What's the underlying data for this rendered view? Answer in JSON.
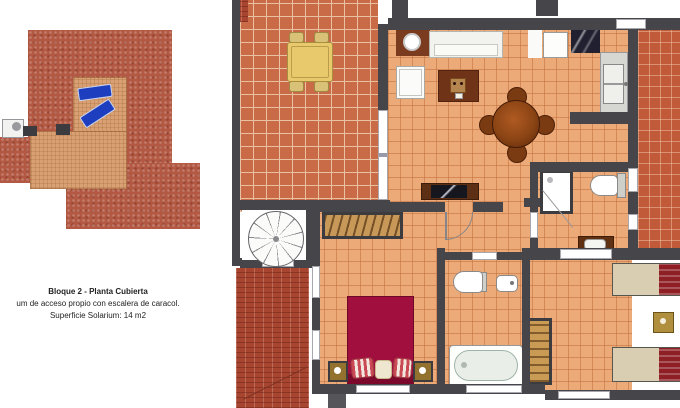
{
  "document": {
    "type": "architectural floor plan sheet",
    "background": "#ffffff"
  },
  "caption": {
    "title": "Bloque 2 - Planta Cubierta",
    "subtitle": "um de acceso propio con escalera de caracol.",
    "area": "Superficie Solarium: 14 m2"
  },
  "left_plan": {
    "name": "roof-solarium-plan",
    "elements": [
      "tiled-roof",
      "solarium-deck",
      "sun-lounger",
      "sun-lounger",
      "stair-access-landing",
      "roof-planter",
      "roof-planter"
    ]
  },
  "main_plan": {
    "name": "apartment-floor-plan",
    "rooms": [
      {
        "name": "front-terrace",
        "furniture": [
          "patio-table",
          "patio-chair",
          "patio-chair",
          "patio-chair",
          "patio-chair"
        ]
      },
      {
        "name": "living-dining-room",
        "furniture": [
          "corner-lamp-unit",
          "sofa",
          "side-table",
          "armchair",
          "tv-console",
          "round-dining-table",
          "dining-chair",
          "dining-chair",
          "dining-chair",
          "dining-chair"
        ]
      },
      {
        "name": "kitchen",
        "furniture": [
          "fridge",
          "cooktop",
          "counter-sink"
        ]
      },
      {
        "name": "side-terrace",
        "furniture": []
      },
      {
        "name": "bathroom-1",
        "furniture": [
          "shower",
          "toilet",
          "vanity-sink"
        ]
      },
      {
        "name": "master-bedroom",
        "furniture": [
          "wardrobe",
          "double-bed",
          "nightstand",
          "nightstand"
        ]
      },
      {
        "name": "bathroom-2",
        "furniture": [
          "toilet",
          "sink",
          "bathtub"
        ]
      },
      {
        "name": "second-bedroom",
        "furniture": [
          "single-bed",
          "single-bed",
          "nightstand",
          "wardrobe"
        ]
      },
      {
        "name": "spiral-staircase",
        "furniture": []
      }
    ]
  },
  "colors": {
    "wall": "#46464a",
    "roof_mottled": "#b25843",
    "roof_brick": "#a84531",
    "terrace_tile": "#c96b46",
    "interior_tile": "#edaa79",
    "side_terrace_tile": "#c05a38",
    "solarium_deck": "#d9a173",
    "lounger_blue": "#1d3fbf",
    "bed_maroon": "#a00f3e",
    "patio_table_yellow": "#e8ca6d",
    "wood_dark": "#5d2f15"
  }
}
